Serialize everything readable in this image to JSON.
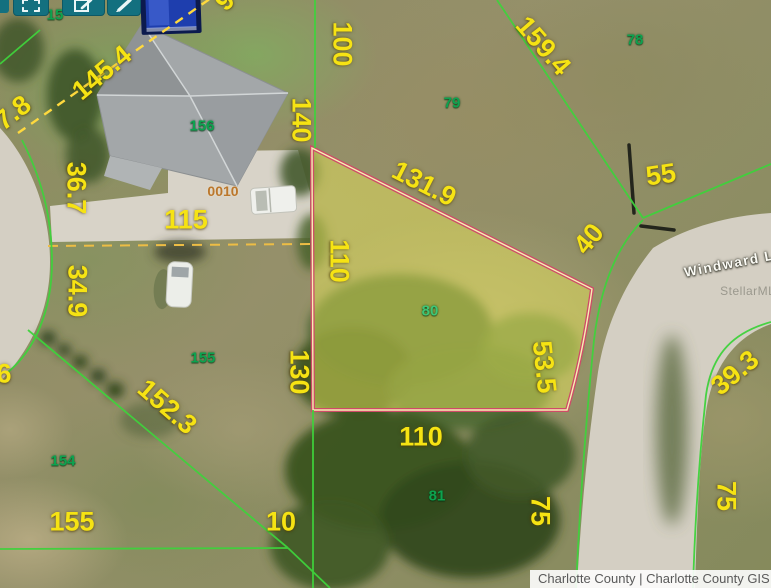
{
  "toolbar": {
    "buttons": [
      {
        "icon": "marquee-select-icon"
      },
      {
        "icon": "edit-note-icon"
      },
      {
        "icon": "draw-pencil-icon"
      }
    ],
    "partial_parcel_number": "15"
  },
  "map": {
    "highlighted_parcel_number": "80",
    "site_address_number": "0010",
    "street_label": "Windward Ln",
    "watermark": "StellarMLS",
    "parcel_numbers": [
      {
        "text": "156"
      },
      {
        "text": "155"
      },
      {
        "text": "154"
      },
      {
        "text": "79"
      },
      {
        "text": "78"
      },
      {
        "text": "80"
      },
      {
        "text": "81"
      }
    ],
    "dimensions": [
      {
        "text": "145.4"
      },
      {
        "text": "7.8"
      },
      {
        "text": "9"
      },
      {
        "text": "36.7"
      },
      {
        "text": "34.9"
      },
      {
        "text": "115"
      },
      {
        "text": "6"
      },
      {
        "text": "152.3"
      },
      {
        "text": "155"
      },
      {
        "text": "10"
      },
      {
        "text": "130"
      },
      {
        "text": "110"
      },
      {
        "text": "140"
      },
      {
        "text": "100"
      },
      {
        "text": "131.9"
      },
      {
        "text": "159.4"
      },
      {
        "text": "55"
      },
      {
        "text": "40"
      },
      {
        "text": "53.5"
      },
      {
        "text": "110"
      },
      {
        "text": "75"
      },
      {
        "text": "75"
      },
      {
        "text": "39.3"
      }
    ]
  },
  "footer": {
    "attribution": "Charlotte County | Charlotte County GIS"
  },
  "colors": {
    "highlight_border": "#cf4a68",
    "highlight_fill": "#e9e55a",
    "boundary_green": "#3fd23c",
    "dimension_yellow": "#f6e313",
    "parcel_id_green": "#0da24f",
    "toolbar_teal": "#13707f"
  }
}
